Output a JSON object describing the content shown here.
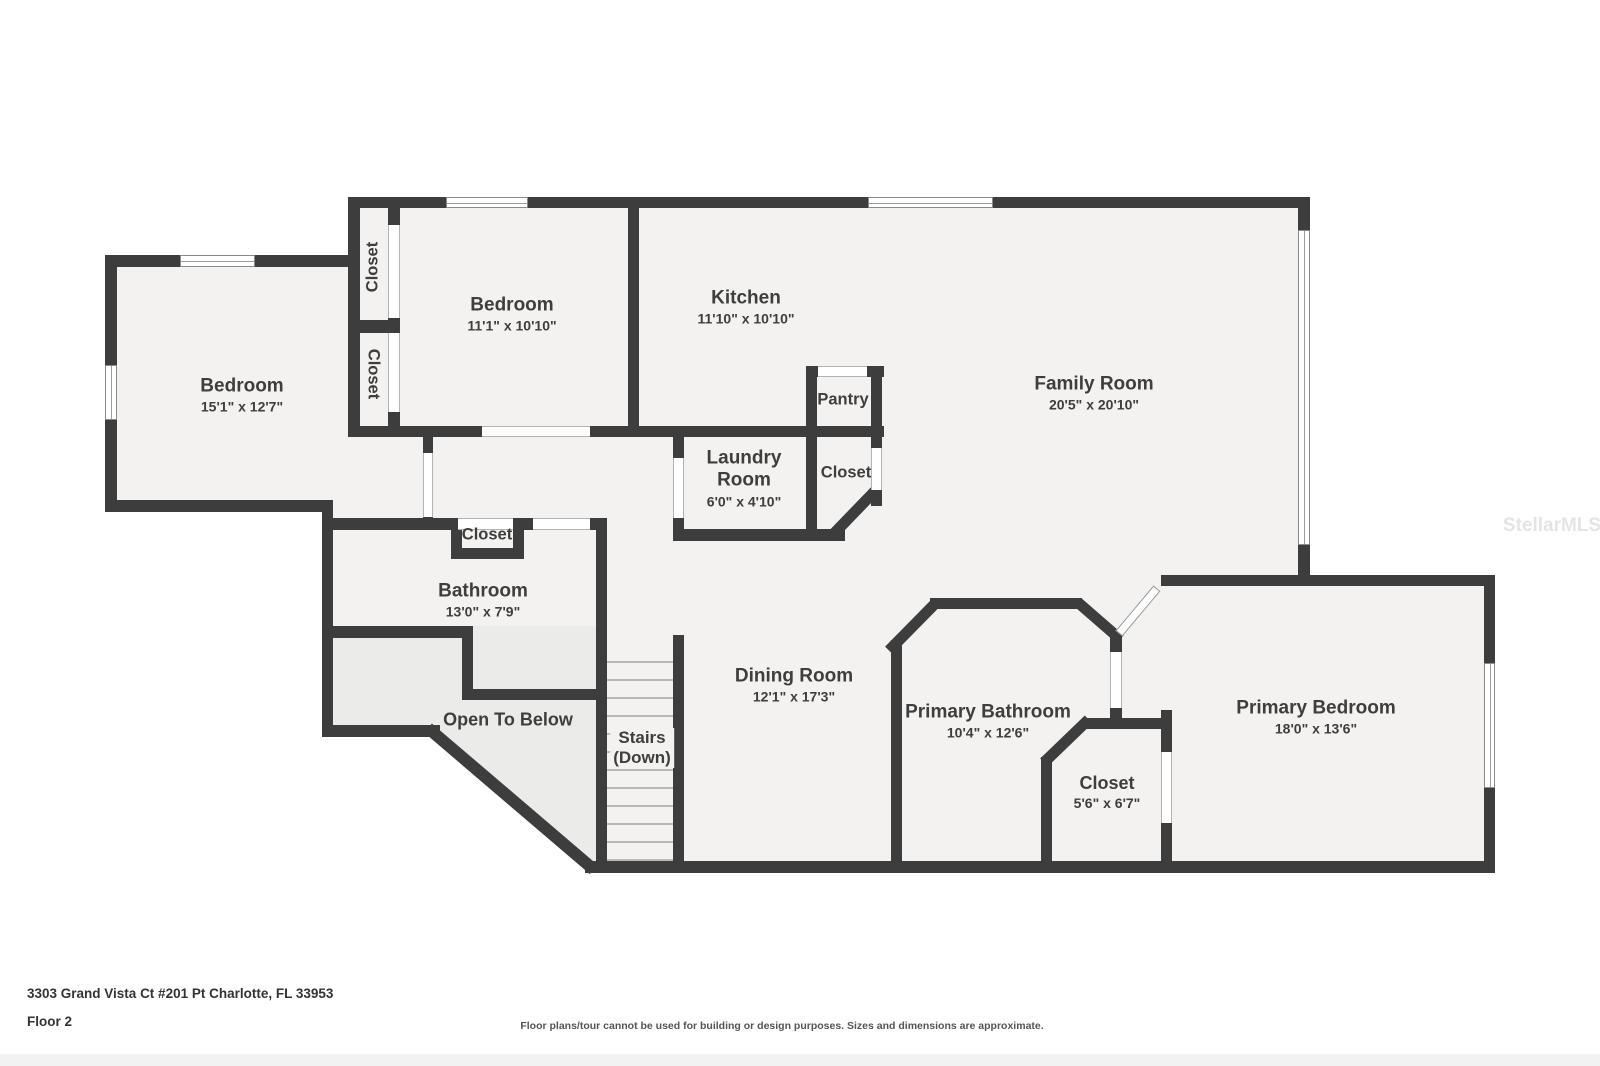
{
  "rooms": {
    "bedroom_left": {
      "name": "Bedroom",
      "dims": "15'1\" x 12'7\""
    },
    "closet_upper": {
      "name": "Closet"
    },
    "closet_lower": {
      "name": "Closet"
    },
    "bedroom_2": {
      "name": "Bedroom",
      "dims": "11'1\" x 10'10\""
    },
    "kitchen": {
      "name": "Kitchen",
      "dims": "11'10\" x 10'10\""
    },
    "family_room": {
      "name": "Family Room",
      "dims": "20'5\" x 20'10\""
    },
    "pantry": {
      "name": "Pantry"
    },
    "laundry_room": {
      "name": "Laundry Room",
      "dims": "6'0\" x 4'10\""
    },
    "closet_laundry": {
      "name": "Closet"
    },
    "closet_bathroom": {
      "name": "Closet"
    },
    "bathroom": {
      "name": "Bathroom",
      "dims": "13'0\" x 7'9\""
    },
    "open_to_below": {
      "name": "Open To Below"
    },
    "stairs": {
      "name": "Stairs",
      "sub": "(Down)"
    },
    "dining_room": {
      "name": "Dining Room",
      "dims": "12'1\" x 17'3\""
    },
    "primary_bathroom": {
      "name": "Primary Bathroom",
      "dims": "10'4\" x 12'6\""
    },
    "closet_primary": {
      "name": "Closet",
      "dims": "5'6\" x 6'7\""
    },
    "primary_bedroom": {
      "name": "Primary Bedroom",
      "dims": "18'0\" x 13'6\""
    }
  },
  "footer": {
    "address": "3303 Grand Vista Ct #201 Pt Charlotte, FL 33953",
    "floor_label": "Floor 2",
    "disclaimer": "Floor plans/tour cannot be used for building or design purposes. Sizes and dimensions are approximate."
  },
  "watermark": "StellarMLS",
  "colors": {
    "wall": "#3d3d3d",
    "floor": "#f3f2f1",
    "open_to_below": "#ebebea",
    "background": "#ffffff"
  }
}
